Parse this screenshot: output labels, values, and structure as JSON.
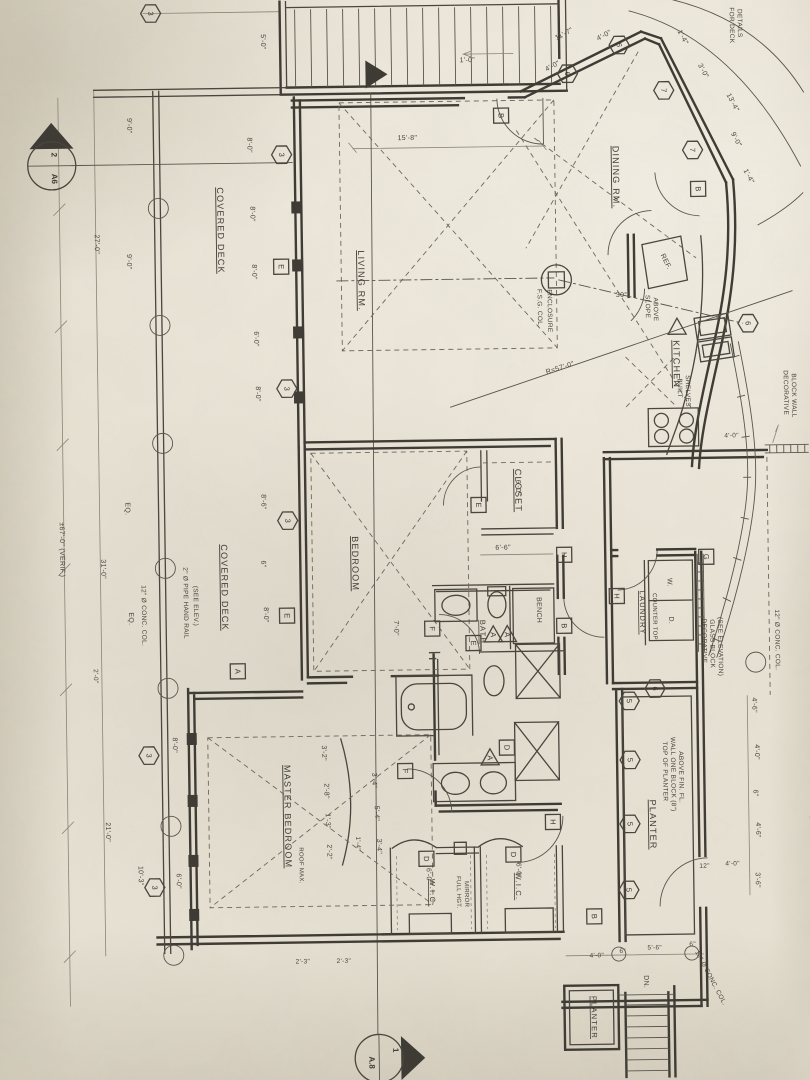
{
  "palette": {
    "paper": "#eae4d6",
    "paper_dark": "#ccc5b3",
    "ink": "#3b3832",
    "faint": "#8a8478"
  },
  "sections": {
    "top": {
      "num": "2",
      "sheet": "A6"
    },
    "bottom": {
      "num": "1",
      "sheet": "A.8"
    }
  },
  "rooms": [
    {
      "t": "COVERED DECK",
      "x": 222,
      "y": 228
    },
    {
      "t": "COVERED DECK",
      "x": 221,
      "y": 585
    },
    {
      "t": "LIVING RM.",
      "x": 362,
      "y": 280
    },
    {
      "t": "DINING RM.",
      "x": 618,
      "y": 180
    },
    {
      "t": "KITCHEN",
      "x": 676,
      "y": 368
    },
    {
      "t": "BEDROOM",
      "x": 352,
      "y": 563
    },
    {
      "t": "CLOSET",
      "x": 516,
      "y": 492
    },
    {
      "t": "BATH",
      "x": 479,
      "y": 633,
      "s": 7.5
    },
    {
      "t": "MASTER BEDROOM",
      "x": 281,
      "y": 815
    },
    {
      "t": "W.I.C.",
      "x": 425,
      "y": 893,
      "s": 7.5
    },
    {
      "t": "W.I.C.",
      "x": 511,
      "y": 888,
      "s": 7.5
    },
    {
      "t": "LAUNDRY",
      "x": 639,
      "y": 616,
      "s": 7.5
    },
    {
      "t": "PLANTER",
      "x": 646,
      "y": 828
    },
    {
      "t": "PLANTER",
      "x": 585,
      "y": 1020,
      "s": 7.5
    }
  ],
  "notes": [
    {
      "t": "2\" Ø PIPE HAND RAIL",
      "x": 183,
      "y": 600
    },
    {
      "t": "(SEE ELEV.)",
      "x": 193,
      "y": 603
    },
    {
      "t": "12\" Ø CONC. COL.",
      "x": 141,
      "y": 612
    },
    {
      "t": "12\" Ø CONC. COL.",
      "x": 774,
      "y": 645
    },
    {
      "t": "12\" Ø CONC. COL.",
      "x": 703,
      "y": 983,
      "r": 63
    },
    {
      "t": "F.S.G. COL.",
      "x": 541,
      "y": 310
    },
    {
      "t": "ENCLOSURE",
      "x": 551,
      "y": 313
    },
    {
      "t": "SLOPE",
      "x": 649,
      "y": 310
    },
    {
      "t": "ABOVE",
      "x": 657,
      "y": 313
    },
    {
      "t": "BUILT",
      "x": 680,
      "y": 392
    },
    {
      "t": "SHELVES",
      "x": 688,
      "y": 395
    },
    {
      "t": "REF.",
      "x": 668,
      "y": 266,
      "r": 64,
      "s": 7
    },
    {
      "t": "W.",
      "x": 667,
      "y": 586,
      "s": 7
    },
    {
      "t": "D.",
      "x": 668,
      "y": 624,
      "s": 7
    },
    {
      "t": "COUNTER TOP",
      "x": 652,
      "y": 620,
      "s": 6
    },
    {
      "t": "DECORATIVE",
      "x": 701,
      "y": 645
    },
    {
      "t": "GLASS BLOCK",
      "x": 709,
      "y": 648
    },
    {
      "t": "(SEE ELEVATION)",
      "x": 717,
      "y": 651
    },
    {
      "t": "DECORATIVE",
      "x": 786,
      "y": 398
    },
    {
      "t": "BLOCK WALL",
      "x": 794,
      "y": 401
    },
    {
      "t": "BLOCK WALL",
      "x": 806,
      "y": 843
    },
    {
      "t": "TOP OF PLANTER",
      "x": 660,
      "y": 775
    },
    {
      "t": "WALL ONE BLOCK (8\")",
      "x": 668,
      "y": 778
    },
    {
      "t": "ABOVE FIN. FL.",
      "x": 676,
      "y": 781
    },
    {
      "t": "FOR DECK",
      "x": 737,
      "y": 30
    },
    {
      "t": "DETAILS",
      "x": 745,
      "y": 28
    },
    {
      "t": "FULL HGT.",
      "x": 452,
      "y": 893,
      "s": 6
    },
    {
      "t": "MIRROR",
      "x": 460,
      "y": 895,
      "s": 6
    },
    {
      "t": "BENCH",
      "x": 536,
      "y": 612,
      "s": 7
    },
    {
      "t": "ROOF MAX.",
      "x": 295,
      "y": 864,
      "s": 6
    },
    {
      "t": "DN.",
      "x": 638,
      "y": 985,
      "s": 7
    },
    {
      "t": "R=57'-0\"",
      "x": 563,
      "y": 372,
      "r": -17,
      "s": 7
    },
    {
      "t": "30°",
      "x": 625,
      "y": 300,
      "r": 0,
      "s": 7
    },
    {
      "t": "±67'-0\" (VERIF.)",
      "x": 60,
      "y": 545,
      "s": 7
    }
  ],
  "dims": [
    {
      "t": "5'-0\"",
      "x": 268,
      "y": 40
    },
    {
      "t": "9'-0\"",
      "x": 133,
      "y": 122
    },
    {
      "t": "27'-0\"",
      "x": 99,
      "y": 240
    },
    {
      "t": "9'-0\"",
      "x": 131,
      "y": 258
    },
    {
      "t": "8'-0\"",
      "x": 253,
      "y": 143
    },
    {
      "t": "8'-0\"",
      "x": 255,
      "y": 212
    },
    {
      "t": "8'-0\"",
      "x": 256,
      "y": 270
    },
    {
      "t": "6'-0\"",
      "x": 257,
      "y": 337
    },
    {
      "t": "8'-0\"",
      "x": 258,
      "y": 392
    },
    {
      "t": "15'-8\"",
      "x": 413,
      "y": 140,
      "r": 0
    },
    {
      "t": "1'-0\"",
      "x": 474,
      "y": 63,
      "r": 0
    },
    {
      "t": "11'-7\"",
      "x": 572,
      "y": 38,
      "r": -27
    },
    {
      "t": "4'-0\"",
      "x": 612,
      "y": 40,
      "r": -27
    },
    {
      "t": "4'-0\"",
      "x": 560,
      "y": 70,
      "r": -27
    },
    {
      "t": "1'-4\"",
      "x": 688,
      "y": 42,
      "r": 63
    },
    {
      "t": "3'-0\"",
      "x": 708,
      "y": 76,
      "r": 63
    },
    {
      "t": "13'-4\"",
      "x": 737,
      "y": 108,
      "r": 63
    },
    {
      "t": "9'-0\"",
      "x": 740,
      "y": 145,
      "r": 63
    },
    {
      "t": "1'-4\"",
      "x": 752,
      "y": 182,
      "r": 63
    },
    {
      "t": "8'-6\"",
      "x": 262,
      "y": 500
    },
    {
      "t": "6\"",
      "x": 261,
      "y": 562
    },
    {
      "t": "8'-0\"",
      "x": 263,
      "y": 613
    },
    {
      "t": "EQ.",
      "x": 126,
      "y": 505
    },
    {
      "t": "EQ.",
      "x": 128,
      "y": 615
    },
    {
      "t": "31'-0\"",
      "x": 101,
      "y": 565
    },
    {
      "t": "2'-0\"",
      "x": 92,
      "y": 672,
      "s": 6.5
    },
    {
      "t": "21'-0\"",
      "x": 102,
      "y": 828
    },
    {
      "t": "10'-3\"",
      "x": 134,
      "y": 872
    },
    {
      "t": "8'-0\"",
      "x": 170,
      "y": 742
    },
    {
      "t": "6'-0\"",
      "x": 172,
      "y": 878
    },
    {
      "t": "6'-6\"",
      "x": 503,
      "y": 551,
      "r": 0
    },
    {
      "t": "7'-0\"",
      "x": 393,
      "y": 628
    },
    {
      "t": "6'-0\"",
      "x": 517,
      "y": 489
    },
    {
      "t": "6'-0\"",
      "x": 422,
      "y": 876
    },
    {
      "t": "6'-0\"",
      "x": 512,
      "y": 872
    },
    {
      "t": "3'-2\"",
      "x": 319,
      "y": 752
    },
    {
      "t": "2'-8\"",
      "x": 321,
      "y": 790
    },
    {
      "t": "1'-3\"",
      "x": 322,
      "y": 820
    },
    {
      "t": "2'-2\"",
      "x": 323,
      "y": 851
    },
    {
      "t": "3'-4\"",
      "x": 369,
      "y": 780
    },
    {
      "t": "5'-4\"",
      "x": 371,
      "y": 813
    },
    {
      "t": "3'-4\"",
      "x": 373,
      "y": 846
    },
    {
      "t": "1'-4\"",
      "x": 352,
      "y": 843,
      "s": 6.5
    },
    {
      "t": "2'-3\"",
      "x": 297,
      "y": 962,
      "r": 0,
      "s": 6.5
    },
    {
      "t": "2'-3\"",
      "x": 338,
      "y": 962,
      "r": 0,
      "s": 6.5
    },
    {
      "t": "4'-6\"",
      "x": 750,
      "y": 710
    },
    {
      "t": "4'-0\"",
      "x": 752,
      "y": 757
    },
    {
      "t": "6\"",
      "x": 750,
      "y": 798
    },
    {
      "t": "4'-6\"",
      "x": 752,
      "y": 835
    },
    {
      "t": "3'-6\"",
      "x": 751,
      "y": 885
    },
    {
      "t": "12\"",
      "x": 700,
      "y": 872,
      "r": 0,
      "s": 6.5
    },
    {
      "t": "4'-0\"",
      "x": 728,
      "y": 870,
      "r": 0,
      "s": 6.5
    },
    {
      "t": "4'-0\"",
      "x": 591,
      "y": 960,
      "r": 0,
      "s": 6.5
    },
    {
      "t": "6\"",
      "x": 617,
      "y": 956,
      "r": 0,
      "s": 6.5
    },
    {
      "t": "5'-6\"",
      "x": 649,
      "y": 953,
      "r": 0,
      "s": 6.5
    },
    {
      "t": "6\"",
      "x": 687,
      "y": 950,
      "r": 0,
      "s": 6.5
    },
    {
      "t": "4'-0\"",
      "x": 733,
      "y": 442,
      "r": 0,
      "s": 6.5
    }
  ],
  "markers": [
    {
      "k": "hex",
      "t": "3",
      "x": 287,
      "y": 153
    },
    {
      "k": "hex",
      "t": "3",
      "x": 289,
      "y": 387
    },
    {
      "k": "hex",
      "t": "3",
      "x": 288,
      "y": 519
    },
    {
      "k": "hex",
      "t": "3",
      "x": 146,
      "y": 752
    },
    {
      "k": "hex",
      "t": "3",
      "x": 150,
      "y": 884
    },
    {
      "k": "hex",
      "t": "3",
      "x": 158,
      "y": 10
    },
    {
      "k": "hex",
      "t": "5",
      "x": 627,
      "y": 704
    },
    {
      "k": "hex",
      "t": "5",
      "x": 627,
      "y": 763
    },
    {
      "k": "hex",
      "t": "5",
      "x": 626,
      "y": 827
    },
    {
      "k": "hex",
      "t": "5",
      "x": 624,
      "y": 893
    },
    {
      "k": "hex",
      "t": "6",
      "x": 574,
      "y": 76
    },
    {
      "k": "hex",
      "t": "6",
      "x": 626,
      "y": 48
    },
    {
      "k": "hex",
      "t": "6",
      "x": 751,
      "y": 328
    },
    {
      "k": "hex",
      "t": "6",
      "x": 653,
      "y": 692
    },
    {
      "k": "hex",
      "t": "7",
      "x": 670,
      "y": 94
    },
    {
      "k": "hex",
      "t": "7",
      "x": 698,
      "y": 154
    },
    {
      "k": "sq",
      "t": "A",
      "x": 236,
      "y": 669
    },
    {
      "k": "sq",
      "t": "B",
      "x": 507,
      "y": 117
    },
    {
      "k": "sq",
      "t": "B",
      "x": 703,
      "y": 193
    },
    {
      "k": "sq",
      "t": "B",
      "x": 563,
      "y": 628
    },
    {
      "k": "sq",
      "t": "B",
      "x": 589,
      "y": 919
    },
    {
      "k": "sq",
      "t": "D",
      "x": 504,
      "y": 749
    },
    {
      "k": "sq",
      "t": "D",
      "x": 422,
      "y": 859
    },
    {
      "k": "sq",
      "t": "D",
      "x": 509,
      "y": 856
    },
    {
      "k": "sq",
      "t": "E",
      "x": 285,
      "y": 265
    },
    {
      "k": "sq",
      "t": "E",
      "x": 286,
      "y": 614
    },
    {
      "k": "sq",
      "t": "E",
      "x": 472,
      "y": 644
    },
    {
      "k": "sq",
      "t": "E",
      "x": 479,
      "y": 506
    },
    {
      "k": "sq",
      "t": "F",
      "x": 431,
      "y": 629
    },
    {
      "k": "sq",
      "t": "F",
      "x": 402,
      "y": 771
    },
    {
      "k": "sq",
      "t": "G",
      "x": 706,
      "y": 561
    },
    {
      "k": "sq",
      "t": "H",
      "x": 549,
      "y": 824
    },
    {
      "k": "sq",
      "t": "H",
      "x": 564,
      "y": 557
    },
    {
      "k": "sq",
      "t": "H",
      "x": 616,
      "y": 599
    },
    {
      "k": "tri",
      "t": "A",
      "x": 492,
      "y": 636
    },
    {
      "k": "tri",
      "t": "A",
      "x": 506,
      "y": 636
    },
    {
      "k": "tri",
      "t": "A",
      "x": 487,
      "y": 759
    },
    {
      "k": "tri",
      "t": "",
      "x": 680,
      "y": 331
    }
  ],
  "columns": [
    {
      "x": 163,
      "y": 205
    },
    {
      "x": 163,
      "y": 322
    },
    {
      "x": 164,
      "y": 440
    },
    {
      "x": 165,
      "y": 565
    },
    {
      "x": 166,
      "y": 685
    },
    {
      "x": 167,
      "y": 823
    },
    {
      "x": 168,
      "y": 952
    },
    {
      "x": 754,
      "y": 667
    },
    {
      "x": 613,
      "y": 957,
      "r": 7
    },
    {
      "x": 686,
      "y": 957,
      "r": 7
    }
  ]
}
